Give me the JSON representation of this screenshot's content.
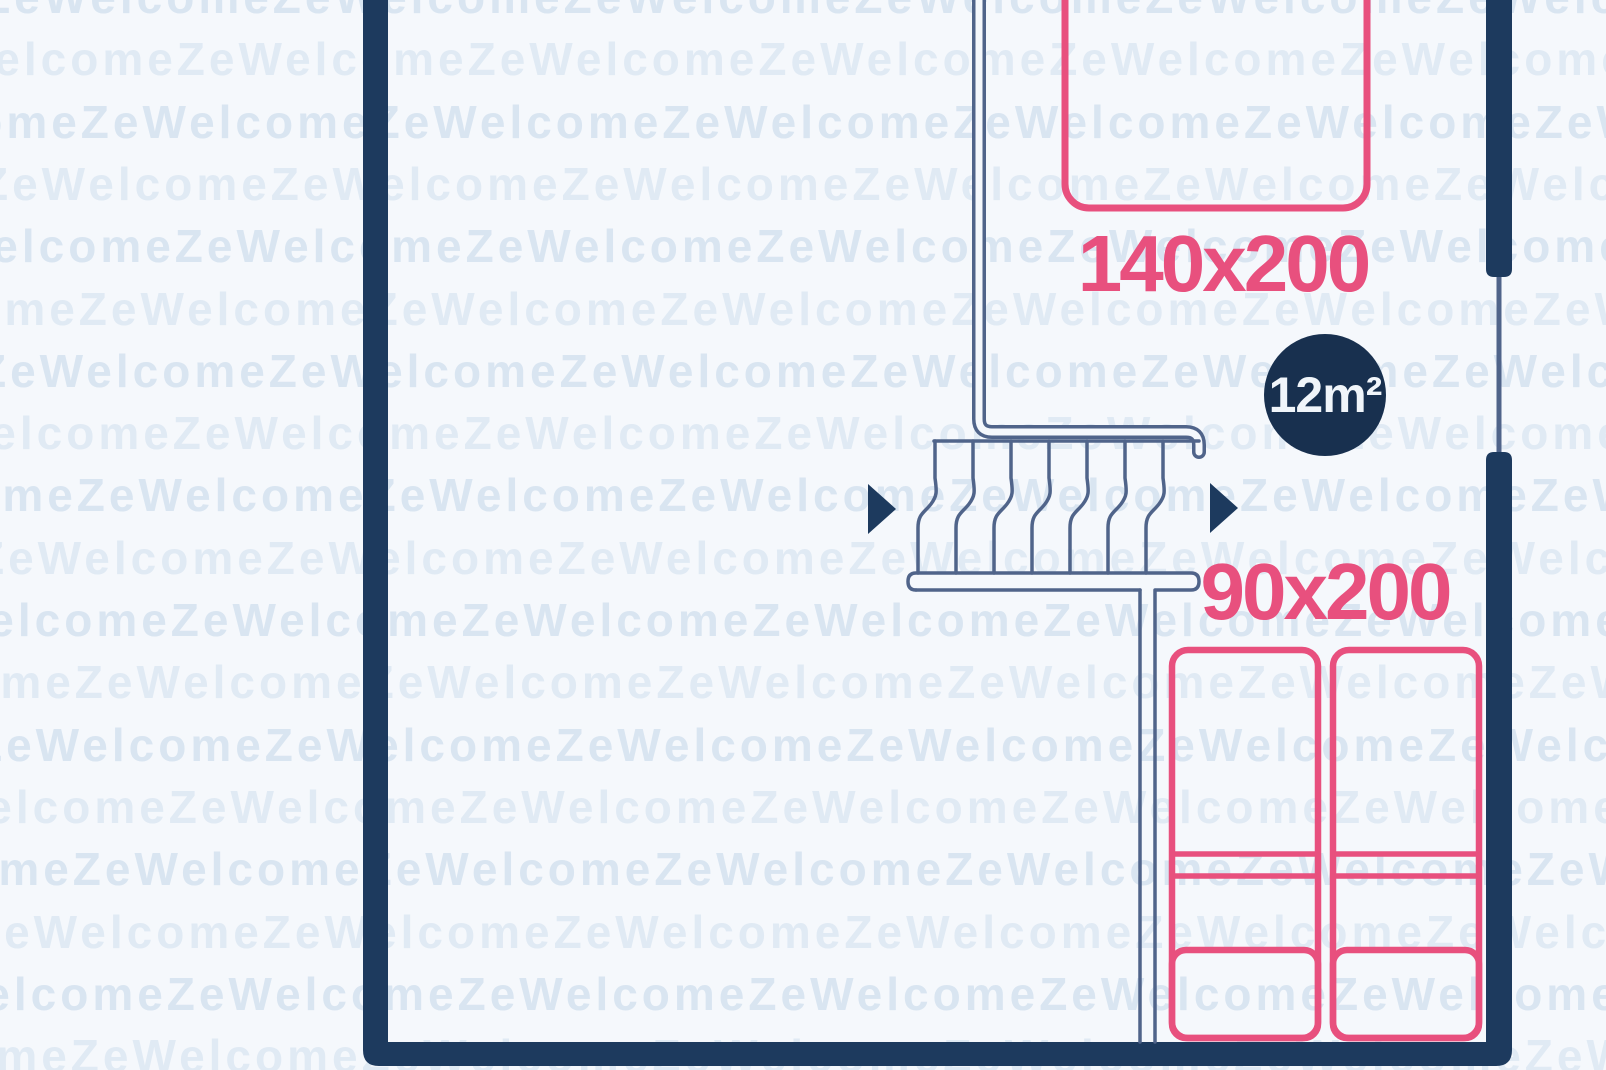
{
  "floorplan": {
    "watermark": {
      "text": "ZeWelcome"
    },
    "labels": {
      "double_bed_size": "140x200",
      "single_bed_size": "90x200"
    },
    "area_badge": {
      "label": "12m²"
    },
    "colors": {
      "background": "#f5f8fc",
      "watermark_text": "#d9e5f1",
      "wall": "#1d3a5e",
      "thin_line": "#50648a",
      "bed_outline": "#e8507e",
      "badge_background": "#18304f",
      "badge_text": "#f0f5fa"
    }
  }
}
